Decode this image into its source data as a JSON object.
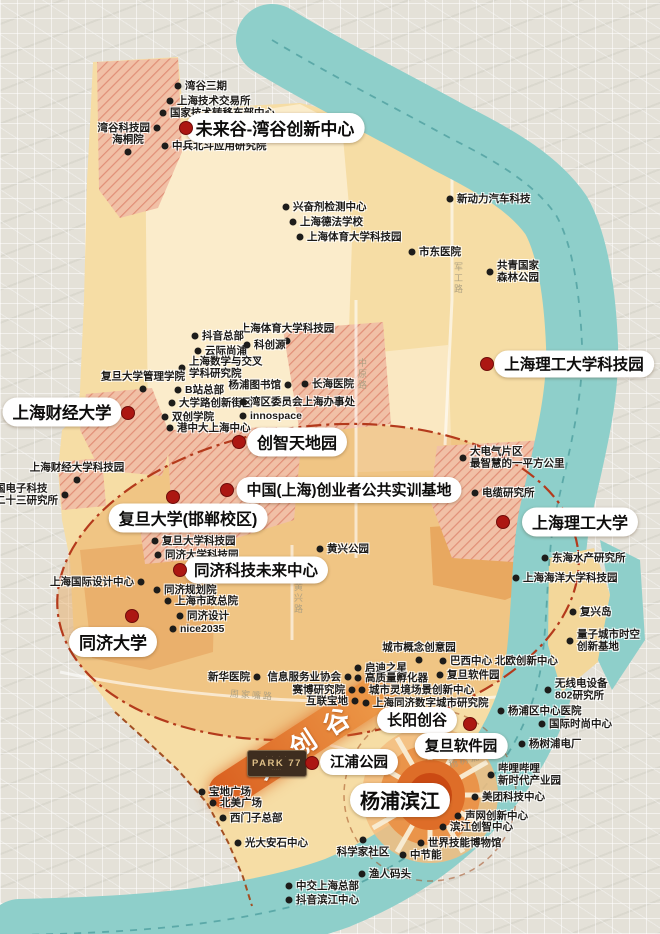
{
  "map": {
    "district_name_features": "Yangpu innovation map",
    "colors": {
      "outside_city": "#e4e1d8",
      "district_fill": "#f6dda5",
      "pale_core": "#fbeccb",
      "valley_fill": "#e9a85e",
      "hatch_bg": "#f1c0a6",
      "hatch_line": "#e18f77",
      "river": "#8ecfca",
      "river_channel": "#4f9f9f",
      "boundary_dash": "#b43a1c",
      "major_dot": "#ac1712",
      "poi_dot": "#1d1c1a",
      "ribbon_orange": "#e06a28",
      "sunburst_core": "#cb4a13"
    },
    "ribbon": {
      "label": "大创谷",
      "x": 302,
      "y": 742,
      "rotate": -33
    },
    "park77": {
      "label": "PARK 77",
      "top_marks": "· · · ·",
      "bottom_marks": "·····"
    },
    "sunburst": {
      "x": 430,
      "y": 795
    },
    "roads": [
      {
        "name": "军工路",
        "x": 452,
        "y": 262,
        "vertical": true
      },
      {
        "name": "中原路",
        "x": 356,
        "y": 358,
        "vertical": true
      },
      {
        "name": "黄兴路",
        "x": 292,
        "y": 582,
        "vertical": true
      },
      {
        "name": "周家嘴路",
        "x": 230,
        "y": 688,
        "rotate": 4
      },
      {
        "name": "杨树浦路",
        "x": 448,
        "y": 752,
        "rotate": -16
      }
    ],
    "majors": [
      {
        "label": "未来谷-湾谷创新中心",
        "dot": [
          186,
          128
        ],
        "pill": [
          275,
          128
        ],
        "fs": 17
      },
      {
        "label": "上海财经大学",
        "dot": [
          128,
          413
        ],
        "pill": [
          62,
          412
        ],
        "fs": 16.5
      },
      {
        "label": "创智天地园",
        "dot": [
          239,
          442
        ],
        "pill": [
          297,
          442
        ],
        "fs": 16
      },
      {
        "label": "中国(上海)创业者公共实训基地",
        "dot": [
          227,
          490
        ],
        "pill": [
          349,
          490
        ],
        "fs": 15
      },
      {
        "label": "复旦大学(邯郸校区)",
        "dot": [
          173,
          497
        ],
        "pill": [
          188,
          518
        ],
        "fs": 16
      },
      {
        "label": "上海理工大学科技园",
        "dot": [
          487,
          364
        ],
        "pill": [
          574,
          364
        ],
        "fs": 15.5
      },
      {
        "label": "上海理工大学",
        "dot": [
          503,
          522
        ],
        "pill": [
          580,
          522
        ],
        "fs": 16
      },
      {
        "label": "同济科技未来中心",
        "dot": [
          180,
          570
        ],
        "pill": [
          256,
          570
        ],
        "fs": 15.5
      },
      {
        "label": "同济大学",
        "dot": [
          132,
          616
        ],
        "pill": [
          113,
          642
        ],
        "fs": 17
      },
      {
        "label": "长阳创谷",
        "dot": [
          470,
          724
        ],
        "pill": [
          417,
          720
        ],
        "fs": 15
      },
      {
        "label": "复旦软件园",
        "dot": null,
        "pill": [
          461,
          746
        ],
        "fs": 14.5
      },
      {
        "label": "江浦公园",
        "dot": [
          312,
          763
        ],
        "pill": [
          359,
          762
        ],
        "fs": 14.5
      },
      {
        "label": "杨浦滨江",
        "dot": null,
        "pill": [
          400,
          800
        ],
        "fs": 20
      }
    ],
    "pois": [
      {
        "label": "湾谷三期",
        "x": 178,
        "y": 86,
        "side": "right"
      },
      {
        "label": "上海技术交易所",
        "x": 170,
        "y": 101,
        "side": "right"
      },
      {
        "label": "国家技术转移东部中心",
        "x": 163,
        "y": 113,
        "side": "right"
      },
      {
        "label": "湾谷科技园",
        "x": 157,
        "y": 128,
        "side": "left"
      },
      {
        "label": "海桐院",
        "x": 128,
        "y": 152,
        "side": "above"
      },
      {
        "label": "中兵北斗应用研究院",
        "x": 165,
        "y": 146,
        "side": "right"
      },
      {
        "label": "兴奋剂检测中心",
        "x": 286,
        "y": 207,
        "side": "right"
      },
      {
        "label": "上海德法学校",
        "x": 293,
        "y": 222,
        "side": "right"
      },
      {
        "label": "上海体育大学科技园",
        "x": 300,
        "y": 237,
        "side": "right"
      },
      {
        "label": "新动力汽车科技",
        "x": 450,
        "y": 199,
        "side": "right"
      },
      {
        "label": "市东医院",
        "x": 412,
        "y": 252,
        "side": "right"
      },
      {
        "label": "共青国家\n森林公园",
        "x": 490,
        "y": 272,
        "side": "right"
      },
      {
        "label": "上海体育大学科技园",
        "x": 287,
        "y": 341,
        "side": "above"
      },
      {
        "label": "抖音总部",
        "x": 195,
        "y": 336,
        "side": "right"
      },
      {
        "label": "云际尚浦",
        "x": 198,
        "y": 351,
        "side": "right"
      },
      {
        "label": "科创源",
        "x": 247,
        "y": 345,
        "side": "right"
      },
      {
        "label": "上海数学与交叉\n学科研究院",
        "x": 182,
        "y": 368,
        "side": "right"
      },
      {
        "label": "复旦大学管理学院",
        "x": 143,
        "y": 389,
        "side": "above"
      },
      {
        "label": "B站总部",
        "x": 178,
        "y": 390,
        "side": "right"
      },
      {
        "label": "杨浦图书馆",
        "x": 288,
        "y": 385,
        "side": "left"
      },
      {
        "label": "长海医院",
        "x": 305,
        "y": 384,
        "side": "right"
      },
      {
        "label": "大学路创新街区",
        "x": 172,
        "y": 403,
        "side": "right"
      },
      {
        "label": "湾区委员会上海办事处",
        "x": 243,
        "y": 402,
        "side": "right"
      },
      {
        "label": "双创学院",
        "x": 165,
        "y": 417,
        "side": "right"
      },
      {
        "label": "innospace",
        "x": 243,
        "y": 416,
        "side": "right"
      },
      {
        "label": "港中大上海中心",
        "x": 170,
        "y": 428,
        "side": "right"
      },
      {
        "label": "上海财经大学科技园",
        "x": 77,
        "y": 480,
        "side": "above"
      },
      {
        "label": "中国电子科技\n第二十三研究所",
        "x": 65,
        "y": 495,
        "side": "left"
      },
      {
        "label": "大电气片区\n最智慧的一平方公里",
        "x": 463,
        "y": 458,
        "side": "right"
      },
      {
        "label": "电缆研究所",
        "x": 475,
        "y": 493,
        "side": "right"
      },
      {
        "label": "复旦大学科技园",
        "x": 155,
        "y": 541,
        "side": "right"
      },
      {
        "label": "同济大学科技园",
        "x": 158,
        "y": 555,
        "side": "right"
      },
      {
        "label": "黄兴公园",
        "x": 320,
        "y": 549,
        "side": "right"
      },
      {
        "label": "东海水产研究所",
        "x": 545,
        "y": 558,
        "side": "right"
      },
      {
        "label": "上海海洋大学科技园",
        "x": 516,
        "y": 578,
        "side": "right"
      },
      {
        "label": "上海国际设计中心",
        "x": 141,
        "y": 582,
        "side": "left"
      },
      {
        "label": "同济规划院",
        "x": 157,
        "y": 590,
        "side": "right"
      },
      {
        "label": "上海市政总院",
        "x": 168,
        "y": 601,
        "side": "right"
      },
      {
        "label": "同济设计",
        "x": 180,
        "y": 616,
        "side": "right"
      },
      {
        "label": "nice2035",
        "x": 173,
        "y": 629,
        "side": "right"
      },
      {
        "label": "复兴岛",
        "x": 573,
        "y": 612,
        "side": "right"
      },
      {
        "label": "量子城市时空\n创新基地",
        "x": 570,
        "y": 641,
        "side": "right"
      },
      {
        "label": "城市概念创意园",
        "x": 419,
        "y": 660,
        "side": "above"
      },
      {
        "label": "巴西中心 北欧创新中心",
        "x": 443,
        "y": 661,
        "side": "right"
      },
      {
        "label": "启迪之星",
        "x": 358,
        "y": 668,
        "side": "right"
      },
      {
        "label": "高质量孵化器",
        "x": 358,
        "y": 678,
        "side": "right"
      },
      {
        "label": "复旦软件园",
        "x": 440,
        "y": 675,
        "side": "right"
      },
      {
        "label": "新华医院",
        "x": 257,
        "y": 677,
        "side": "left"
      },
      {
        "label": "信息服务业协会",
        "x": 348,
        "y": 677,
        "side": "left"
      },
      {
        "label": "赛博研究院",
        "x": 352,
        "y": 690,
        "side": "left"
      },
      {
        "label": "城市灵境场景创新中心",
        "x": 362,
        "y": 690,
        "side": "right"
      },
      {
        "label": "互联宝地",
        "x": 355,
        "y": 701,
        "side": "left"
      },
      {
        "label": "上海同济数字城市研究院",
        "x": 366,
        "y": 703,
        "side": "right"
      },
      {
        "label": "无线电设备\n802研究所",
        "x": 548,
        "y": 690,
        "side": "right"
      },
      {
        "label": "杨浦区中心医院",
        "x": 501,
        "y": 711,
        "side": "right"
      },
      {
        "label": "国际时尚中心",
        "x": 542,
        "y": 724,
        "side": "right"
      },
      {
        "label": "杨树浦电厂",
        "x": 522,
        "y": 744,
        "side": "right"
      },
      {
        "label": "哔哩哔哩\n新时代产业园",
        "x": 491,
        "y": 775,
        "side": "right"
      },
      {
        "label": "美团科技中心",
        "x": 475,
        "y": 797,
        "side": "right"
      },
      {
        "label": "声网创新中心",
        "x": 458,
        "y": 816,
        "side": "right"
      },
      {
        "label": "滨江创智中心",
        "x": 443,
        "y": 827,
        "side": "right"
      },
      {
        "label": "世界技能博物馆",
        "x": 421,
        "y": 843,
        "side": "right"
      },
      {
        "label": "中节能",
        "x": 403,
        "y": 855,
        "side": "right"
      },
      {
        "label": "科学家社区",
        "x": 363,
        "y": 840,
        "side": "below"
      },
      {
        "label": "渔人码头",
        "x": 362,
        "y": 874,
        "side": "right"
      },
      {
        "label": "中交上海总部",
        "x": 289,
        "y": 886,
        "side": "right"
      },
      {
        "label": "抖音滨江中心",
        "x": 289,
        "y": 900,
        "side": "right"
      },
      {
        "label": "宝地广场",
        "x": 202,
        "y": 792,
        "side": "right"
      },
      {
        "label": "北美广场",
        "x": 213,
        "y": 803,
        "side": "right"
      },
      {
        "label": "西门子总部",
        "x": 223,
        "y": 818,
        "side": "right"
      },
      {
        "label": "光大安石中心",
        "x": 238,
        "y": 843,
        "side": "right"
      }
    ]
  }
}
